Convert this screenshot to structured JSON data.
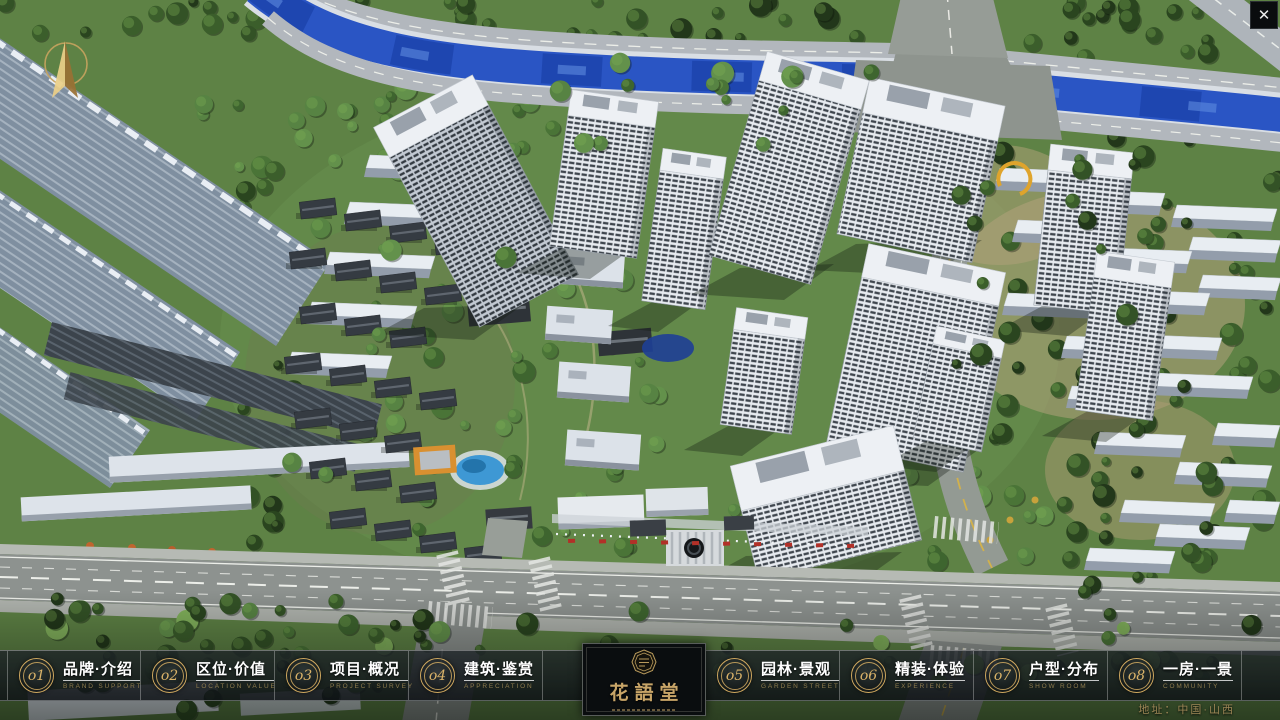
{
  "window": {
    "close_glyph": "✕"
  },
  "logo": {
    "title": "花語堂"
  },
  "footer": {
    "address": "地址：中国·山西"
  },
  "nav": {
    "items": [
      {
        "num": "o1",
        "cn": "品牌·介绍",
        "en": "BRAND SUPPORT"
      },
      {
        "num": "o2",
        "cn": "区位·价值",
        "en": "LOCATION VALUE"
      },
      {
        "num": "o3",
        "cn": "项目·概况",
        "en": "PROJECT SURVEY"
      },
      {
        "num": "o4",
        "cn": "建筑·鉴赏",
        "en": "APPRECIATION"
      },
      {
        "num": "o5",
        "cn": "园林·景观",
        "en": "GARDEN STREET"
      },
      {
        "num": "o6",
        "cn": "精装·体验",
        "en": "EXPERIENCE"
      },
      {
        "num": "o7",
        "cn": "户型·分布",
        "en": "SHOW ROOM"
      },
      {
        "num": "o8",
        "cn": "一房·一景",
        "en": "COMMUNITY"
      }
    ]
  }
}
